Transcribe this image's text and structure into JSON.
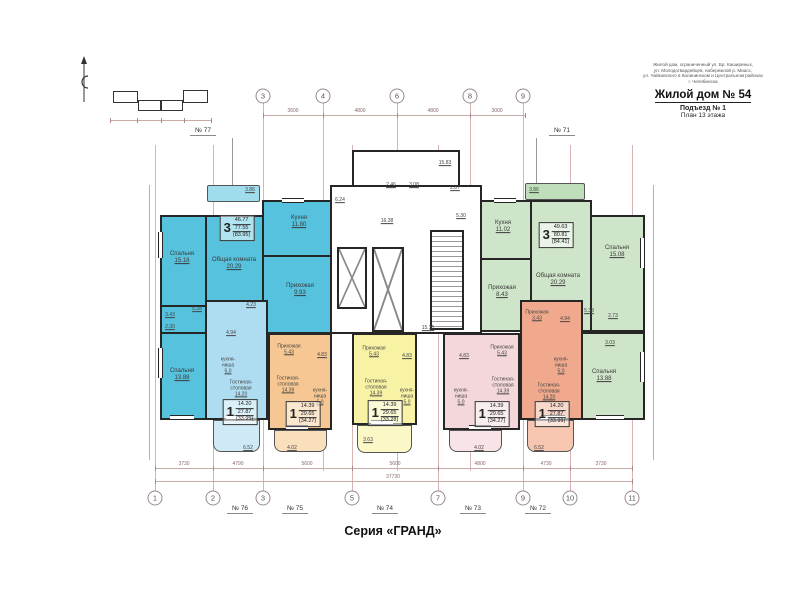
{
  "palette": {
    "wall": "#262626",
    "axis_line": "#d8b4b4",
    "apt77_blue": "#56c2de",
    "apt76_lightblue": "#aeddf1",
    "apt75_orange": "#f6c792",
    "apt74_yellow": "#f8f2a4",
    "apt73_pink": "#f4d7da",
    "apt72_salmon": "#f0a98c",
    "apt71_green": "#cfe5c9"
  },
  "title_block": {
    "line1": "Жилой дом, ограниченный ул. Бр. Кашириных,",
    "line2": "ул. Молодогвардейцев, набережной р. Миасс,",
    "line3": "ул. Чайковского в Калининском и Центральном районах",
    "line4": "г. Челябинска",
    "title": "Жилой дом № 54",
    "entrance": "Подъезд № 1",
    "plan": "План 13 этажа"
  },
  "footer": {
    "series": "Серия «ГРАНД»"
  },
  "units": {
    "u77": "№ 77",
    "u71": "№ 71",
    "u76": "№ 76",
    "u75": "№ 75",
    "u74": "№ 74",
    "u73": "№ 73",
    "u72": "№ 72"
  },
  "axes": {
    "top": [
      "3",
      "4",
      "6",
      "8",
      "9"
    ],
    "bottom": [
      "1",
      "2",
      "3",
      "5",
      "7",
      "9",
      "10",
      "11"
    ]
  },
  "dims": {
    "top": [
      "3600",
      "4800",
      "4800",
      "3000"
    ],
    "bottom": [
      "3730",
      "4790",
      "5600",
      "5600",
      "4800",
      "4730",
      "3730"
    ],
    "total": "37730"
  },
  "core": {
    "bay": "15.83",
    "v1": "2.46",
    "v2": "3.08",
    "v3": "2.87",
    "v4": "6.24",
    "v5": "5.30",
    "corridor": "16.38",
    "corridor2": "15.35"
  },
  "apartments": {
    "a77": {
      "type": "3",
      "a1": "46.77",
      "a2": "77.55",
      "a3": "(83.95)",
      "balcony": "3.86",
      "bedroom1_n": "Спальня",
      "bedroom1_a": "15.18",
      "living_n": "Общая комната",
      "living_a": "20.29",
      "kitchen_n": "Кухня",
      "kitchen_a": "11.80",
      "hall_n": "Прихожая",
      "hall_a": "9.93",
      "bedroom2_n": "Спальня",
      "bedroom2_a": "13.88",
      "s1": "5.28",
      "s2": "3.43",
      "s3": "2.30"
    },
    "a71": {
      "type": "3",
      "a1": "49.63",
      "a2": "80.81",
      "a3": "(84.41)",
      "balcony": "3.86",
      "kitchen_n": "Кухня",
      "kitchen_a": "11.02",
      "living_n": "Общая комната",
      "living_a": "20.29",
      "bedroom1_n": "Спальня",
      "bedroom1_a": "15.08",
      "hall_n": "Прихожая",
      "hall_a": "8.43",
      "bedroom2_n": "Спальня",
      "bedroom2_a": "13.88",
      "s1": "5.38",
      "s2": "2.73",
      "s3": "3.03"
    },
    "a76": {
      "type": "1",
      "a1": "14.20",
      "a2": "27.87",
      "a3": "(33.95)",
      "balcony": "6.52",
      "hall_a": "4.23",
      "bath_a": "4.94",
      "kn_n": "кухня-",
      "kn_n2": "ниша",
      "kn_a": "5,0",
      "living_n": "Гостиная-",
      "living_n2": "столовая",
      "living_a": "14.20"
    },
    "a75": {
      "type": "1",
      "a1": "14.39",
      "a2": "29.65",
      "a3": "(34.27)",
      "balcony": "4.02",
      "hall_n": "Прихожая",
      "hall_a": "5.43",
      "bath_a": "4.83",
      "kn_n": "кухня-",
      "kn_n2": "ниша",
      "kn_a": "5,0",
      "living_n": "Гостиная-",
      "living_n2": "столовая",
      "living_a": "14.39"
    },
    "a74": {
      "type": "1",
      "a1": "14.39",
      "a2": "29.65",
      "a3": "(33.28)",
      "balcony": "3.63",
      "hall_n": "Прихожая",
      "hall_a": "5.43",
      "bath_a": "4.83",
      "kn_n": "кухня-",
      "kn_n2": "ниша",
      "kn_a": "5,0",
      "living_n": "Гостиная-",
      "living_n2": "столовая",
      "living_a": "14.39"
    },
    "a73": {
      "type": "1",
      "a1": "14.39",
      "a2": "29.65",
      "a3": "(34.27)",
      "balcony": "4.02",
      "hall_n": "Прихожая",
      "hall_a": "5.43",
      "bath_a": "4.83",
      "kn_n": "кухня-",
      "kn_n2": "ниша",
      "kn_a": "5,0",
      "living_n": "Гостиная-",
      "living_n2": "столовая",
      "living_a": "14.39"
    },
    "a72": {
      "type": "1",
      "a1": "14.20",
      "a2": "27.87",
      "a3": "(33.99)",
      "balcony": "6.52",
      "hall_n": "Прихожая",
      "hall_a": "3.43",
      "bath_a": "4.94",
      "kn_n": "кухня-",
      "kn_n2": "ниша",
      "kn_a": "5,0",
      "living_n": "Гостиная-",
      "living_n2": "столовая",
      "living_a": "14.20"
    }
  }
}
